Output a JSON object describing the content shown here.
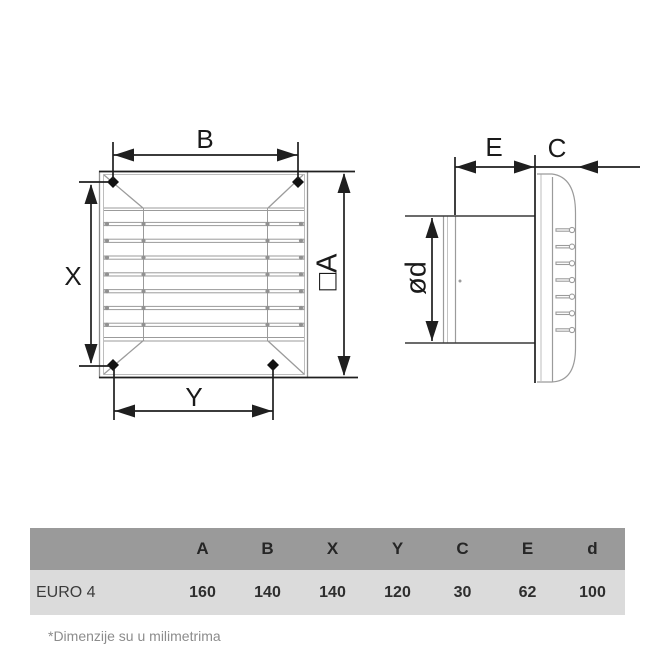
{
  "diagram": {
    "front_view": {
      "dim_b": "B",
      "dim_x": "X",
      "dim_y": "Y",
      "dim_a": "□A"
    },
    "side_view": {
      "dim_e": "E",
      "dim_c": "C",
      "dim_d": "ød"
    }
  },
  "table": {
    "columns": [
      "A",
      "B",
      "X",
      "Y",
      "C",
      "E",
      "d"
    ],
    "rows": [
      {
        "model": "EURO 4",
        "values": [
          "160",
          "140",
          "140",
          "120",
          "30",
          "62",
          "100"
        ]
      }
    ]
  },
  "footnote": "*Dimenzije su u milimetrima",
  "colors": {
    "table_header_bg": "#9a9a9a",
    "table_row_bg": "#dbdbdb",
    "drawing_line_gray": "#9b9b9b",
    "dimension_line_dark": "#1f1f1f",
    "footnote_text": "#8c8c8c"
  }
}
